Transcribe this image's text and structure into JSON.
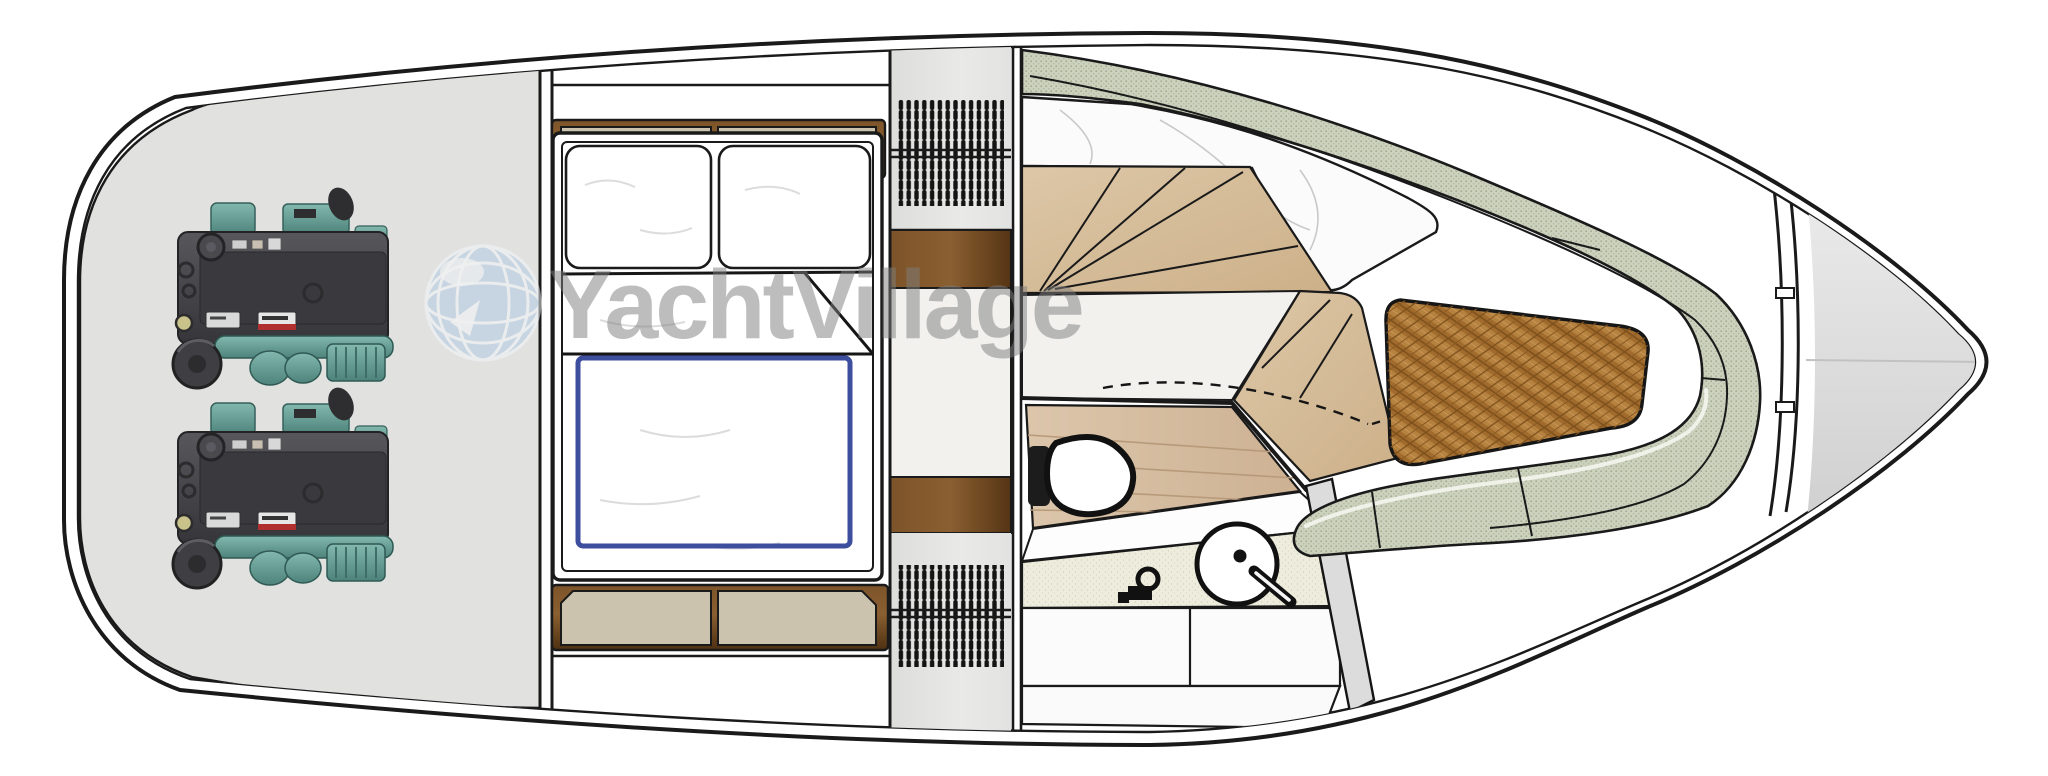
{
  "watermark": {
    "text": "YachtVillage",
    "icon": "globe-icon"
  },
  "palette": {
    "hull_outline": "#1a1a1a",
    "engine_room_gray": "#e1e1e0",
    "cabinet_tan": "#cbc3ad",
    "wood_walnut": "#6b4423",
    "wood_oak_light": "#d9c2a1",
    "head_floor_wood": "#d9c3a8",
    "bed_trim_blue": "#3d4e9e",
    "upholstery_sage": "#cdd2bf",
    "table_wood": "#b5823f",
    "marble_white": "#fbfbfb",
    "engine_teal": "#5d9d95",
    "engine_body": "#46464a",
    "bow_deck_gray": "#d8d8d8",
    "watermark_gray": "#7e7e7e"
  }
}
